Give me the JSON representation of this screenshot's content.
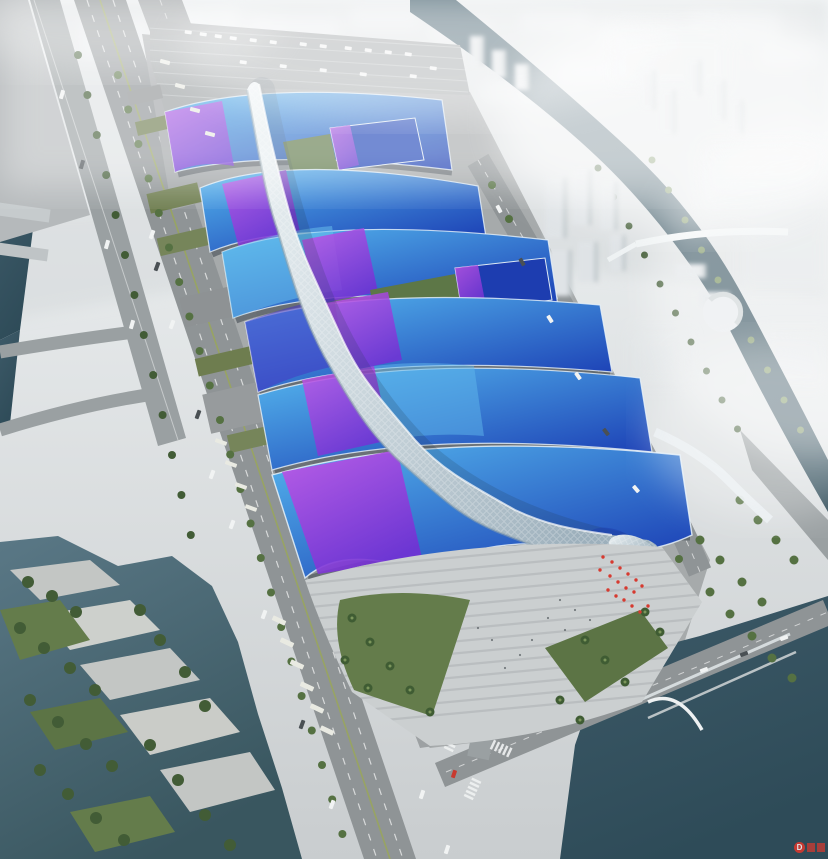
{
  "image": {
    "description": "Aerial rendering of a large exhibition and convention center: rows of wave-shaped exhibition hall roofs in blue with purple ribbon stripes, crossed by a white serpentine central concourse spine ending in an entrance canopy, surrounded by parking aprons, tree-lined boulevards, canals, a waterfront park and a hazy white city skyline.",
    "width_px": 828,
    "height_px": 859
  },
  "palette": {
    "sky_haze": "#f3f6f7",
    "city_haze": "#e7ebed",
    "ground": "#a6aaab",
    "road": "#8f9496",
    "plaza": "#cbcfd0",
    "roof_light": "#55b7ee",
    "roof_deep": "#1b3eb4",
    "ribbon_light": "#c455e6",
    "ribbon_deep": "#7330d4",
    "spine_light": "#edf3f5",
    "spine_shade": "#9db0bc",
    "water_mid": "#3d5a68",
    "water_deep": "#2e4b58",
    "lake": "#5a7886",
    "tree": "#425c36",
    "lawn": "#647c4b",
    "accent_red": "#d63a30"
  },
  "watermark": {
    "symbol": "D",
    "color": "#e0382d"
  },
  "scene": {
    "regions": [
      "hazy-city-skyline",
      "exhibition-hall-roofs",
      "central-spine-concourse",
      "entrance-plaza",
      "top-parking-lot",
      "left-boulevard",
      "service-road",
      "left-river",
      "right-canal",
      "pedestrian-bridge",
      "waterfront-park",
      "bottom-canal",
      "road-intersection"
    ]
  }
}
